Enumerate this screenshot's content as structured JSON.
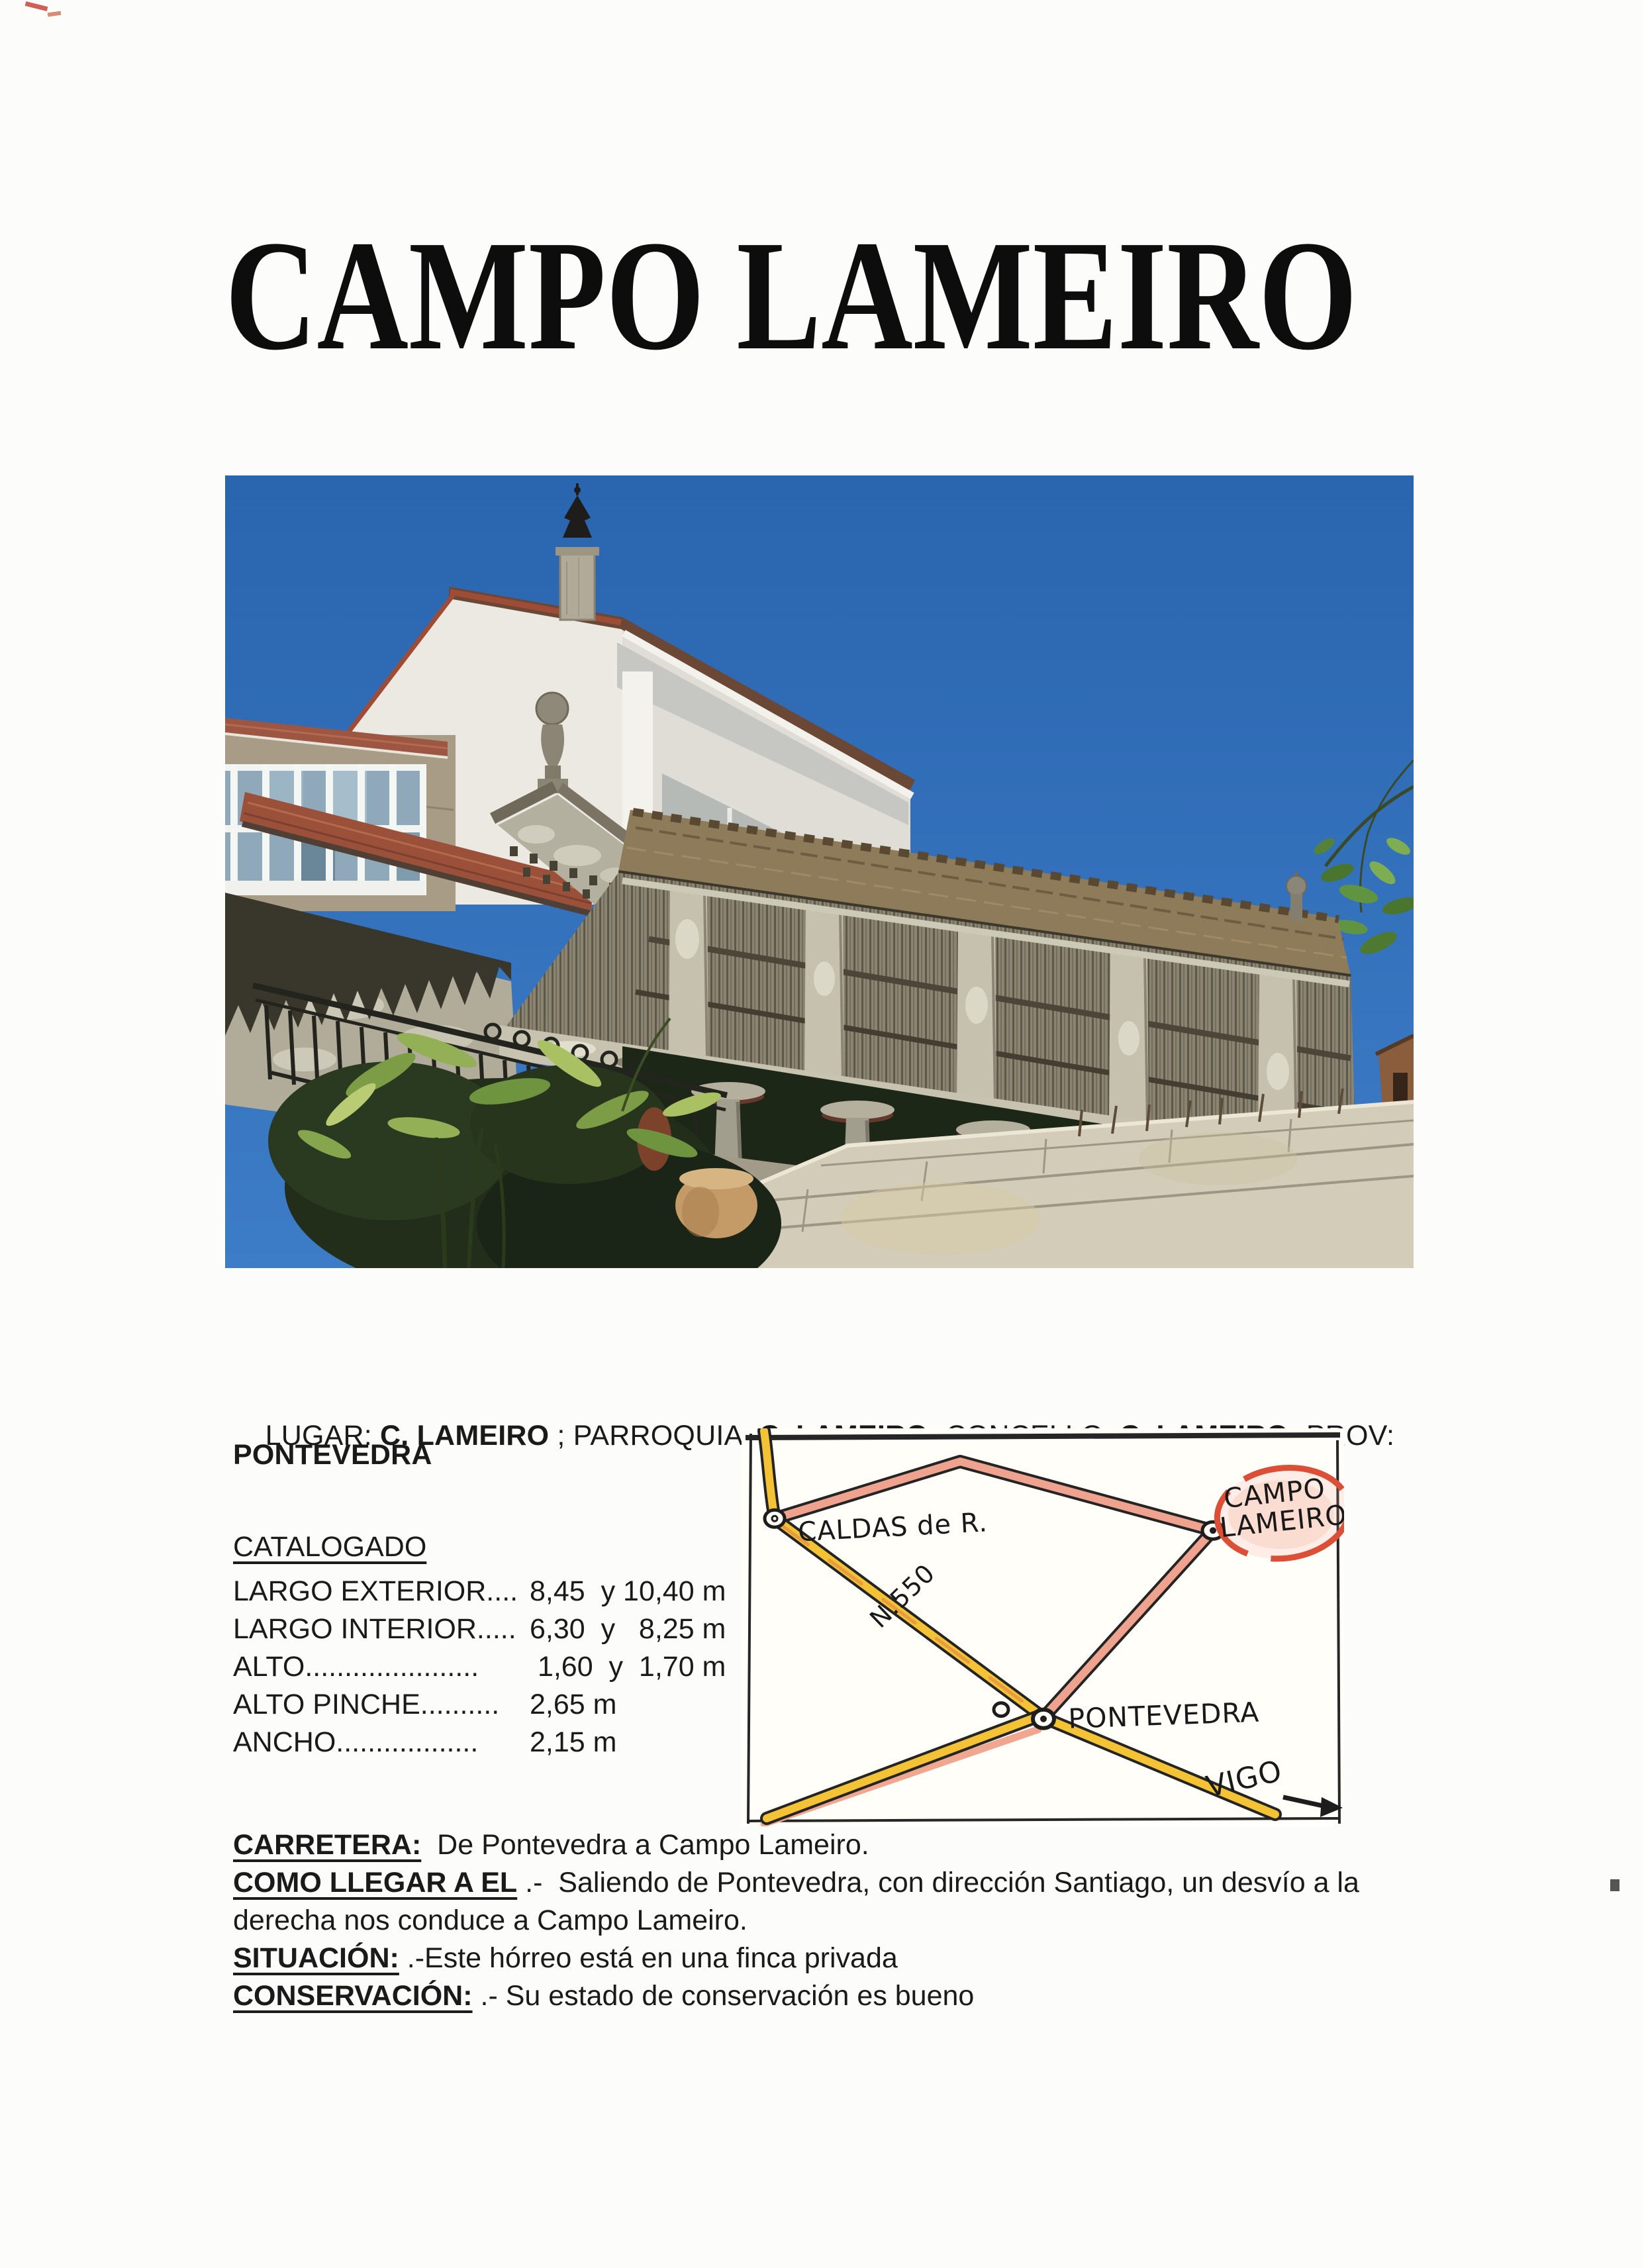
{
  "title": "CAMPO LAMEIRO",
  "location": {
    "parts": [
      {
        "text": "LUGAR: "
      },
      {
        "text": "C. LAMEIRO",
        "bold": true
      },
      {
        "text": " ; PARROQUIA: "
      },
      {
        "text": "C. LAMEIRO;",
        "bold": true
      },
      {
        "text": " CONCELLO: "
      },
      {
        "text": "C. LAMEIRO;",
        "bold": true
      },
      {
        "text": " PROV:"
      }
    ],
    "line2": "PONTEVEDRA"
  },
  "catalog": {
    "heading": "CATALOGADO",
    "rows": [
      {
        "label": "LARGO EXTERIOR....",
        "value": "8,45  y 10,40 m"
      },
      {
        "label": "LARGO INTERIOR.....",
        "value": "6,30  y   8,25 m"
      },
      {
        "label": "ALTO......................",
        "value": " 1,60  y  1,70 m"
      },
      {
        "label": "ALTO PINCHE..........",
        "value": "2,65 m"
      },
      {
        "label": "ANCHO..................",
        "value": "2,15 m"
      }
    ]
  },
  "map": {
    "labels": {
      "caldas": "CALDAS de R.",
      "road": "N.550",
      "campo_line1": "CAMPO",
      "campo_line2": "LAMEIRO",
      "pontevedra": "PONTEVEDRA",
      "vigo": "VIGO"
    },
    "colors": {
      "road_yellow": "#f3c235",
      "road_pink": "#efa28d",
      "ink": "#1d1d1d",
      "highlight_red": "#dc4f36"
    }
  },
  "sections": [
    {
      "lead": "CARRETERA:",
      "rest": "  De Pontevedra a Campo Lameiro."
    },
    {
      "lead": "COMO LLEGAR A EL",
      "rest": " .-  Saliendo de Pontevedra, con dirección Santiago, un desvío a la"
    },
    {
      "lead": "",
      "rest": "derecha nos conduce a Campo Lameiro."
    },
    {
      "lead": "SITUACIÓN:",
      "rest": " .-Este hórreo está en una finca privada"
    },
    {
      "lead": "CONSERVACIÓN:",
      "rest": " .- Su estado de conservación es bueno"
    }
  ]
}
